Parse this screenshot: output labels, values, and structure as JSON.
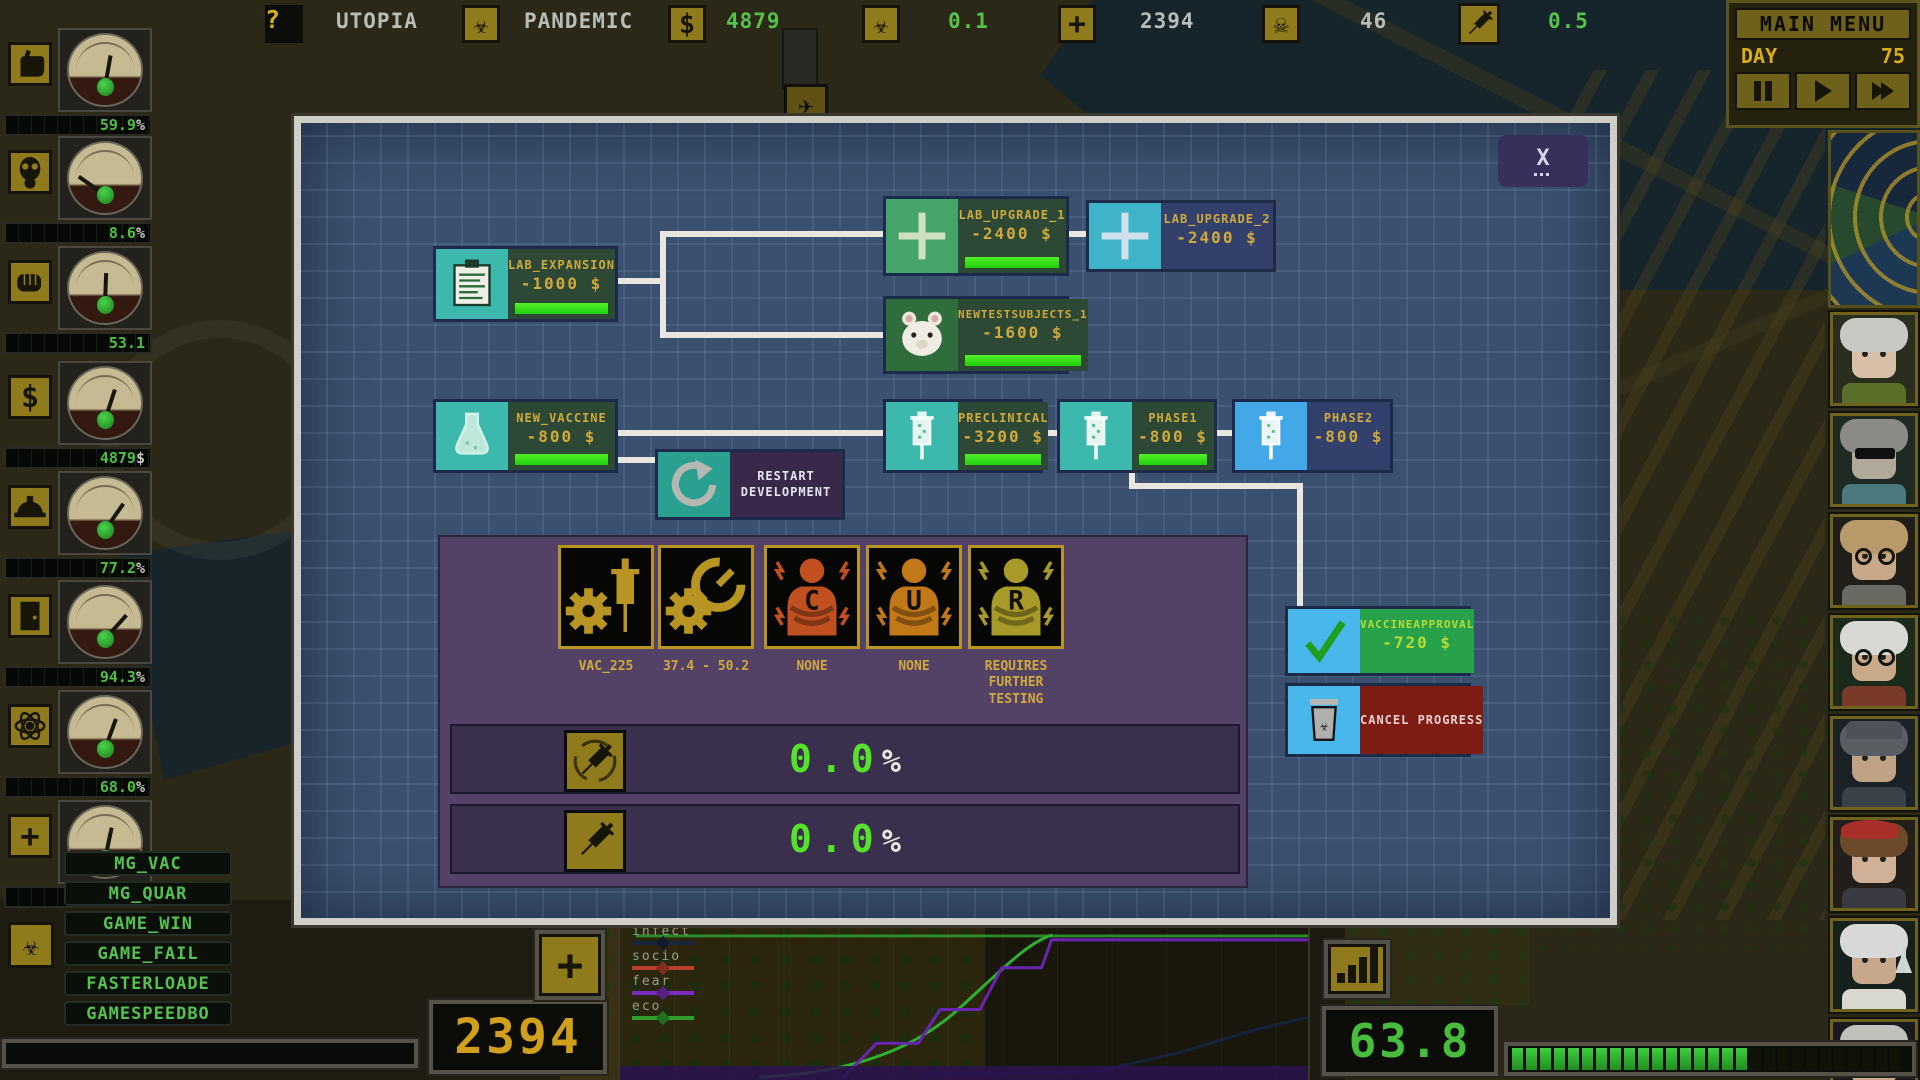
{
  "hud": {
    "top_bar": {
      "help": "?",
      "utopia_label": "UTOPIA",
      "pandemic_label": "PANDEMIC",
      "money_value": "4879",
      "infection_rate": "0.1",
      "population_value": "2394",
      "deaths_value": "46",
      "vaccine_rate": "0.5"
    },
    "main_menu": {
      "label": "MAIN MENU",
      "day_label": "DAY",
      "day_value": "75"
    },
    "left_gauges": [
      {
        "icon": "fist-icon",
        "value": "59.9",
        "unit": "%",
        "needle_deg": 10
      },
      {
        "icon": "gas-mask-icon",
        "value": "8.6",
        "unit": "%",
        "needle_deg": -55
      },
      {
        "icon": "punch-icon",
        "value": "53.1",
        "unit": "",
        "needle_deg": 2
      },
      {
        "icon": "dollar-icon",
        "value": "4879",
        "unit": "$",
        "needle_deg": 18
      },
      {
        "icon": "hardhat-icon",
        "value": "77.2",
        "unit": "%",
        "needle_deg": 35
      },
      {
        "icon": "door-icon",
        "value": "94.3",
        "unit": "%",
        "needle_deg": 42
      },
      {
        "icon": "atom-icon",
        "value": "68.0",
        "unit": "%",
        "needle_deg": 20
      },
      {
        "icon": "medical-cross-icon",
        "value": "",
        "unit": "",
        "needle_deg": 12
      }
    ],
    "cheat_menu": [
      "MG_VAC",
      "MG_QUAR",
      "GAME_WIN",
      "GAME_FAIL",
      "FASTERLOADE",
      "GAMESPEEDBO"
    ],
    "bottom": {
      "population_display": "2394",
      "score_display": "63.8",
      "graph_legend": [
        {
          "label": "infect",
          "color": "#18263f"
        },
        {
          "label": "socio",
          "color": "#b84028"
        },
        {
          "label": "fear",
          "color": "#7a2cc0"
        },
        {
          "label": "eco",
          "color": "#2f9e2f"
        }
      ],
      "segment_bar": {
        "total": 28,
        "lit": 17
      }
    }
  },
  "dialog": {
    "close_label": "X",
    "nodes": [
      {
        "id": "lab_expansion",
        "title": "LAB_EXPANSION",
        "cost": "-1000 $",
        "state": "researched",
        "icon": "clipboard-icon"
      },
      {
        "id": "lab_upgrade_1",
        "title": "LAB_UPGRADE_1",
        "cost": "-2400 $",
        "state": "researched",
        "icon": "plus-icon"
      },
      {
        "id": "lab_upgrade_2",
        "title": "LAB_UPGRADE_2",
        "cost": "-2400 $",
        "state": "available",
        "icon": "plus-icon"
      },
      {
        "id": "newtestsubjects_1",
        "title": "NEWTESTSUBJECTS_1",
        "cost": "-1600 $",
        "state": "researched",
        "icon": "hamster-icon"
      },
      {
        "id": "new_vaccine",
        "title": "NEW_VACCINE",
        "cost": "-800 $",
        "state": "researched",
        "icon": "flask-icon"
      },
      {
        "id": "preclinical",
        "title": "PRECLINICAL",
        "cost": "-3200 $",
        "state": "researched",
        "icon": "syringe-icon"
      },
      {
        "id": "phase1",
        "title": "PHASE1",
        "cost": "-800 $",
        "state": "researched",
        "icon": "syringe-icon"
      },
      {
        "id": "phase2",
        "title": "PHASE2",
        "cost": "-800 $",
        "state": "available",
        "icon": "syringe-icon"
      },
      {
        "id": "vaccineapproval",
        "title": "VACCINEAPPROVAL",
        "cost": "-720 $",
        "state": "approval",
        "icon": "check-icon"
      }
    ],
    "restart_label": "RESTART DEVELOPMENT",
    "cancel_label": "CANCEL PROGRESS",
    "details": {
      "stats": [
        {
          "icon": "gear-syringe-icon",
          "label": "VAC_225"
        },
        {
          "icon": "gear-gauge-icon",
          "label": "37.4 - 50.2"
        },
        {
          "icon": "patient-c-icon",
          "label": "NONE"
        },
        {
          "icon": "patient-u-icon",
          "label": "NONE"
        },
        {
          "icon": "patient-r-icon",
          "label": "REQUIRES FURTHER TESTING"
        }
      ],
      "progress_rows": [
        {
          "icon": "syringe-cycle-icon",
          "value": "0.0",
          "unit": "%"
        },
        {
          "icon": "syringe-icon",
          "value": "0.0",
          "unit": "%"
        }
      ]
    }
  },
  "portraits": [
    {
      "accessory": "none",
      "bg": "#2a2e1e",
      "hair": "#c8c8c4",
      "skin": "#d8c0a8",
      "shirt": "#5a6e2a",
      "acc_color": "#000000"
    },
    {
      "accessory": "sunglasses",
      "bg": "#1e2a22",
      "hair": "#8a8a86",
      "skin": "#b0a898",
      "shirt": "#4a7a7e",
      "acc_color": "#101010"
    },
    {
      "accessory": "glasses",
      "bg": "#201e18",
      "hair": "#b89a6a",
      "skin": "#c8a888",
      "shirt": "#6a6a62",
      "acc_color": "#14140f"
    },
    {
      "accessory": "glasses",
      "bg": "#1c2a1c",
      "hair": "#d8d8d4",
      "skin": "#c8aa8a",
      "shirt": "#7a3a2a",
      "acc_color": "#14140f"
    },
    {
      "accessory": "cap",
      "bg": "#1a2226",
      "hair": "#5a5e62",
      "skin": "#c0a284",
      "shirt": "#3a4248",
      "acc_color": "#4c5258"
    },
    {
      "accessory": "beret",
      "bg": "#221e1a",
      "hair": "#6a4a2a",
      "skin": "#d0b096",
      "shirt": "#3a3a42",
      "acc_color": "#a83028"
    },
    {
      "accessory": "flask",
      "bg": "#16201c",
      "hair": "#d8d8d8",
      "skin": "#c8a88a",
      "shirt": "#d8d8d0",
      "acc_color": "#ccd6d4"
    },
    {
      "accessory": "bowtie",
      "bg": "#1a1a1e",
      "hair": "#c0c0bc",
      "skin": "#c8a88a",
      "shirt": "#b8b8b0",
      "acc_color": "#a82828"
    }
  ]
}
